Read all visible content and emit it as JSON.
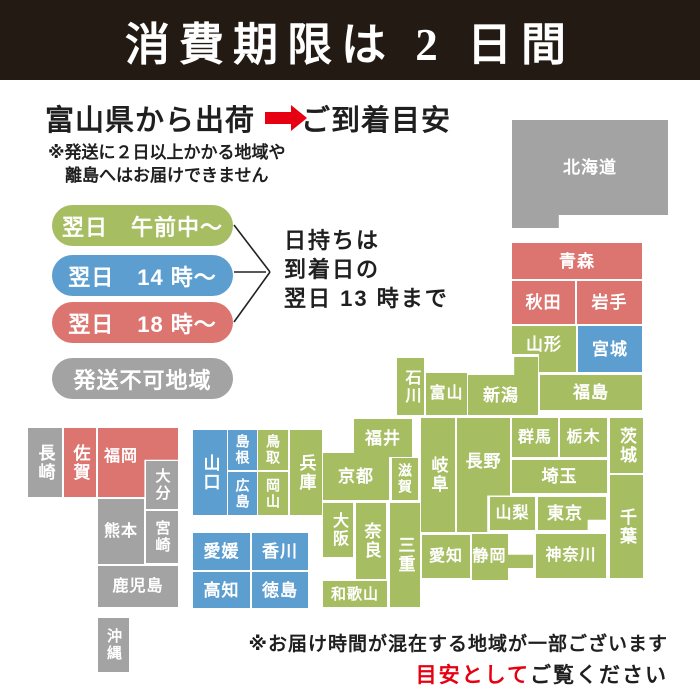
{
  "header": {
    "title": "消費期限は 2 日間"
  },
  "intro": {
    "ship_from": "富山県から出荷",
    "arrow_icon": "right-arrow",
    "arrival": "ご到着目安",
    "note1": "※発送に２日以上かかる地域や",
    "note2": "離島へはお届けできません"
  },
  "legend": {
    "items": [
      {
        "key": "green",
        "label": "翌日　午前中～"
      },
      {
        "key": "blue",
        "label": "翌日　14 時～"
      },
      {
        "key": "red",
        "label": "翌日　18 時～"
      },
      {
        "key": "gray",
        "label": "発送不可地域"
      }
    ],
    "shelf_life_note": [
      "日持ちは",
      "到着日の",
      "翌日 13 時まで"
    ]
  },
  "footer": {
    "note": "※お届け時間が混在する地域が一部ございます",
    "emphasis": "目安として",
    "suffix": "ご覧ください"
  },
  "colors": {
    "green": "#a6bd62",
    "blue": "#5b9ecf",
    "red": "#dc7470",
    "gray": "#a3a3a3",
    "accent_red": "#e60012",
    "header_bg": "#231b13",
    "text": "#1f1f1f"
  },
  "map": {
    "prefectures": [
      {
        "name": "北海道",
        "zone": "gray",
        "x": 512,
        "y": 120,
        "w": 156,
        "h": 108,
        "dir": "h",
        "dy": -7,
        "clip": "polygon(0 0,100% 0,100% 88%,30% 88%,30% 100%,0 100%)"
      },
      {
        "name": "青森",
        "zone": "red",
        "x": 512,
        "y": 243,
        "w": 130,
        "h": 36,
        "dir": "h"
      },
      {
        "name": "秋田",
        "zone": "red",
        "x": 512,
        "y": 281,
        "w": 63,
        "h": 43,
        "dir": "h"
      },
      {
        "name": "岩手",
        "zone": "red",
        "x": 577,
        "y": 281,
        "w": 65,
        "h": 43,
        "dir": "h"
      },
      {
        "name": "山形",
        "zone": "green",
        "x": 512,
        "y": 326,
        "w": 64,
        "h": 46,
        "dir": "h",
        "dy": -5,
        "clip": "polygon(0 0,100% 0,100% 100%,42% 100%,42% 61%,0 61%)"
      },
      {
        "name": "宮城",
        "zone": "blue",
        "x": 578,
        "y": 326,
        "w": 64,
        "h": 46,
        "dir": "h"
      },
      {
        "name": "新潟",
        "zone": "green",
        "x": 468,
        "y": 357,
        "w": 70,
        "h": 58,
        "dir": "h",
        "dy": 9,
        "dx": -2,
        "clip": "polygon(66% 0,100% 0,100% 100%,0 100%,0 31%,66% 31%)"
      },
      {
        "name": "福島",
        "zone": "green",
        "x": 540,
        "y": 375,
        "w": 102,
        "h": 35,
        "dir": "h"
      },
      {
        "name": "石川",
        "zone": "green",
        "x": 397,
        "y": 358,
        "w": 27,
        "h": 57,
        "dir": "v",
        "fs": 16
      },
      {
        "name": "富山",
        "zone": "green",
        "x": 426,
        "y": 373,
        "w": 41,
        "h": 42,
        "dir": "h",
        "fs": 16
      },
      {
        "name": "福井",
        "zone": "green",
        "x": 354,
        "y": 419,
        "w": 58,
        "h": 38,
        "dir": "h"
      },
      {
        "name": "長野",
        "zone": "green",
        "x": 457,
        "y": 418,
        "w": 53,
        "h": 114,
        "dir": "h",
        "dy": -14,
        "clip": "polygon(0 0,100% 0,100% 68%,57% 68%,57% 100%,0 100%)"
      },
      {
        "name": "群馬",
        "zone": "green",
        "x": 512,
        "y": 418,
        "w": 46,
        "h": 39,
        "dir": "h",
        "fs": 16
      },
      {
        "name": "栃木",
        "zone": "green",
        "x": 560,
        "y": 418,
        "w": 47,
        "h": 39,
        "dir": "h",
        "fs": 16
      },
      {
        "name": "茨城",
        "zone": "green",
        "x": 610,
        "y": 418,
        "w": 33,
        "h": 55,
        "dir": "v"
      },
      {
        "name": "埼玉",
        "zone": "green",
        "x": 512,
        "y": 460,
        "w": 95,
        "h": 33,
        "dir": "h"
      },
      {
        "name": "山梨",
        "zone": "green",
        "x": 490,
        "y": 497,
        "w": 45,
        "h": 33,
        "dir": "h",
        "fs": 16
      },
      {
        "name": "東京",
        "zone": "green",
        "x": 538,
        "y": 497,
        "w": 68,
        "h": 33,
        "dir": "h",
        "dx": -7,
        "clip": "polygon(0 0,100% 0,100% 69%,73% 69%,73% 100%,0 100%)"
      },
      {
        "name": "千葉",
        "zone": "green",
        "x": 610,
        "y": 475,
        "w": 33,
        "h": 103,
        "dir": "v"
      },
      {
        "name": "神奈川",
        "zone": "green",
        "x": 536,
        "y": 534,
        "w": 70,
        "h": 44,
        "dir": "h",
        "fs": 16
      },
      {
        "name": "静岡",
        "zone": "green",
        "x": 472,
        "y": 534,
        "w": 61,
        "h": 46,
        "dir": "h",
        "dx": -13,
        "fs": 16,
        "clip": "polygon(0 0,59% 0,59% 45%,100% 45%,100% 74%,59% 74%,59% 100%,0 100%)"
      },
      {
        "name": "愛知",
        "zone": "green",
        "x": 422,
        "y": 535,
        "w": 48,
        "h": 43,
        "dir": "h",
        "fs": 16
      },
      {
        "name": "岐阜",
        "zone": "green",
        "x": 421,
        "y": 418,
        "w": 34,
        "h": 114,
        "dir": "v"
      },
      {
        "name": "滋賀",
        "zone": "green",
        "x": 392,
        "y": 458,
        "w": 26,
        "h": 42,
        "dir": "v",
        "fs": 14
      },
      {
        "name": "京都",
        "zone": "green",
        "x": 323,
        "y": 453,
        "w": 66,
        "h": 47,
        "dir": "h"
      },
      {
        "name": "兵庫",
        "zone": "green",
        "x": 290,
        "y": 430,
        "w": 32,
        "h": 85,
        "dir": "v"
      },
      {
        "name": "大阪",
        "zone": "green",
        "x": 323,
        "y": 503,
        "w": 30,
        "h": 54,
        "dir": "v",
        "fs": 16
      },
      {
        "name": "奈良",
        "zone": "green",
        "x": 356,
        "y": 503,
        "w": 30,
        "h": 76,
        "dir": "v"
      },
      {
        "name": "三重",
        "zone": "green",
        "x": 390,
        "y": 503,
        "w": 30,
        "h": 104,
        "dir": "v"
      },
      {
        "name": "和歌山",
        "zone": "green",
        "x": 323,
        "y": 581,
        "w": 64,
        "h": 26,
        "dir": "h",
        "fs": 15
      },
      {
        "name": "鳥取",
        "zone": "green",
        "x": 258,
        "y": 430,
        "w": 30,
        "h": 40,
        "dir": "v",
        "fs": 14
      },
      {
        "name": "岡山",
        "zone": "green",
        "x": 258,
        "y": 472,
        "w": 30,
        "h": 43,
        "dir": "v",
        "fs": 14
      },
      {
        "name": "島根",
        "zone": "blue",
        "x": 228,
        "y": 430,
        "w": 29,
        "h": 40,
        "dir": "v",
        "fs": 14
      },
      {
        "name": "広島",
        "zone": "blue",
        "x": 228,
        "y": 472,
        "w": 29,
        "h": 43,
        "dir": "v",
        "fs": 14
      },
      {
        "name": "山口",
        "zone": "blue",
        "x": 193,
        "y": 430,
        "w": 34,
        "h": 85,
        "dir": "v"
      },
      {
        "name": "愛媛",
        "zone": "blue",
        "x": 193,
        "y": 533,
        "w": 57,
        "h": 37,
        "dir": "h"
      },
      {
        "name": "香川",
        "zone": "blue",
        "x": 252,
        "y": 533,
        "w": 56,
        "h": 37,
        "dir": "h"
      },
      {
        "name": "高知",
        "zone": "blue",
        "x": 193,
        "y": 572,
        "w": 57,
        "h": 36,
        "dir": "h"
      },
      {
        "name": "徳島",
        "zone": "blue",
        "x": 252,
        "y": 572,
        "w": 56,
        "h": 36,
        "dir": "h"
      },
      {
        "name": "福岡",
        "zone": "red",
        "x": 98,
        "y": 428,
        "w": 80,
        "h": 69,
        "dir": "h",
        "dx": -17,
        "dy": -6,
        "fs": 16,
        "clip": "polygon(0 0,100% 0,100% 46%,58% 46%,58% 100%,0 100%)"
      },
      {
        "name": "佐賀",
        "zone": "red",
        "x": 64,
        "y": 428,
        "w": 32,
        "h": 69,
        "dir": "v"
      },
      {
        "name": "長崎",
        "zone": "gray",
        "x": 28,
        "y": 428,
        "w": 34,
        "h": 69,
        "dir": "v"
      },
      {
        "name": "大分",
        "zone": "gray",
        "x": 146,
        "y": 461,
        "w": 32,
        "h": 48,
        "dir": "v",
        "fs": 15
      },
      {
        "name": "熊本",
        "zone": "gray",
        "x": 98,
        "y": 499,
        "w": 46,
        "h": 65,
        "dir": "h",
        "fs": 16
      },
      {
        "name": "宮崎",
        "zone": "gray",
        "x": 146,
        "y": 511,
        "w": 32,
        "h": 52,
        "dir": "v",
        "fs": 15
      },
      {
        "name": "鹿児島",
        "zone": "gray",
        "x": 98,
        "y": 566,
        "w": 80,
        "h": 41,
        "dir": "h",
        "fs": 16
      },
      {
        "name": "沖縄",
        "zone": "gray",
        "x": 98,
        "y": 618,
        "w": 31,
        "h": 54,
        "dir": "v",
        "fs": 15
      }
    ]
  }
}
